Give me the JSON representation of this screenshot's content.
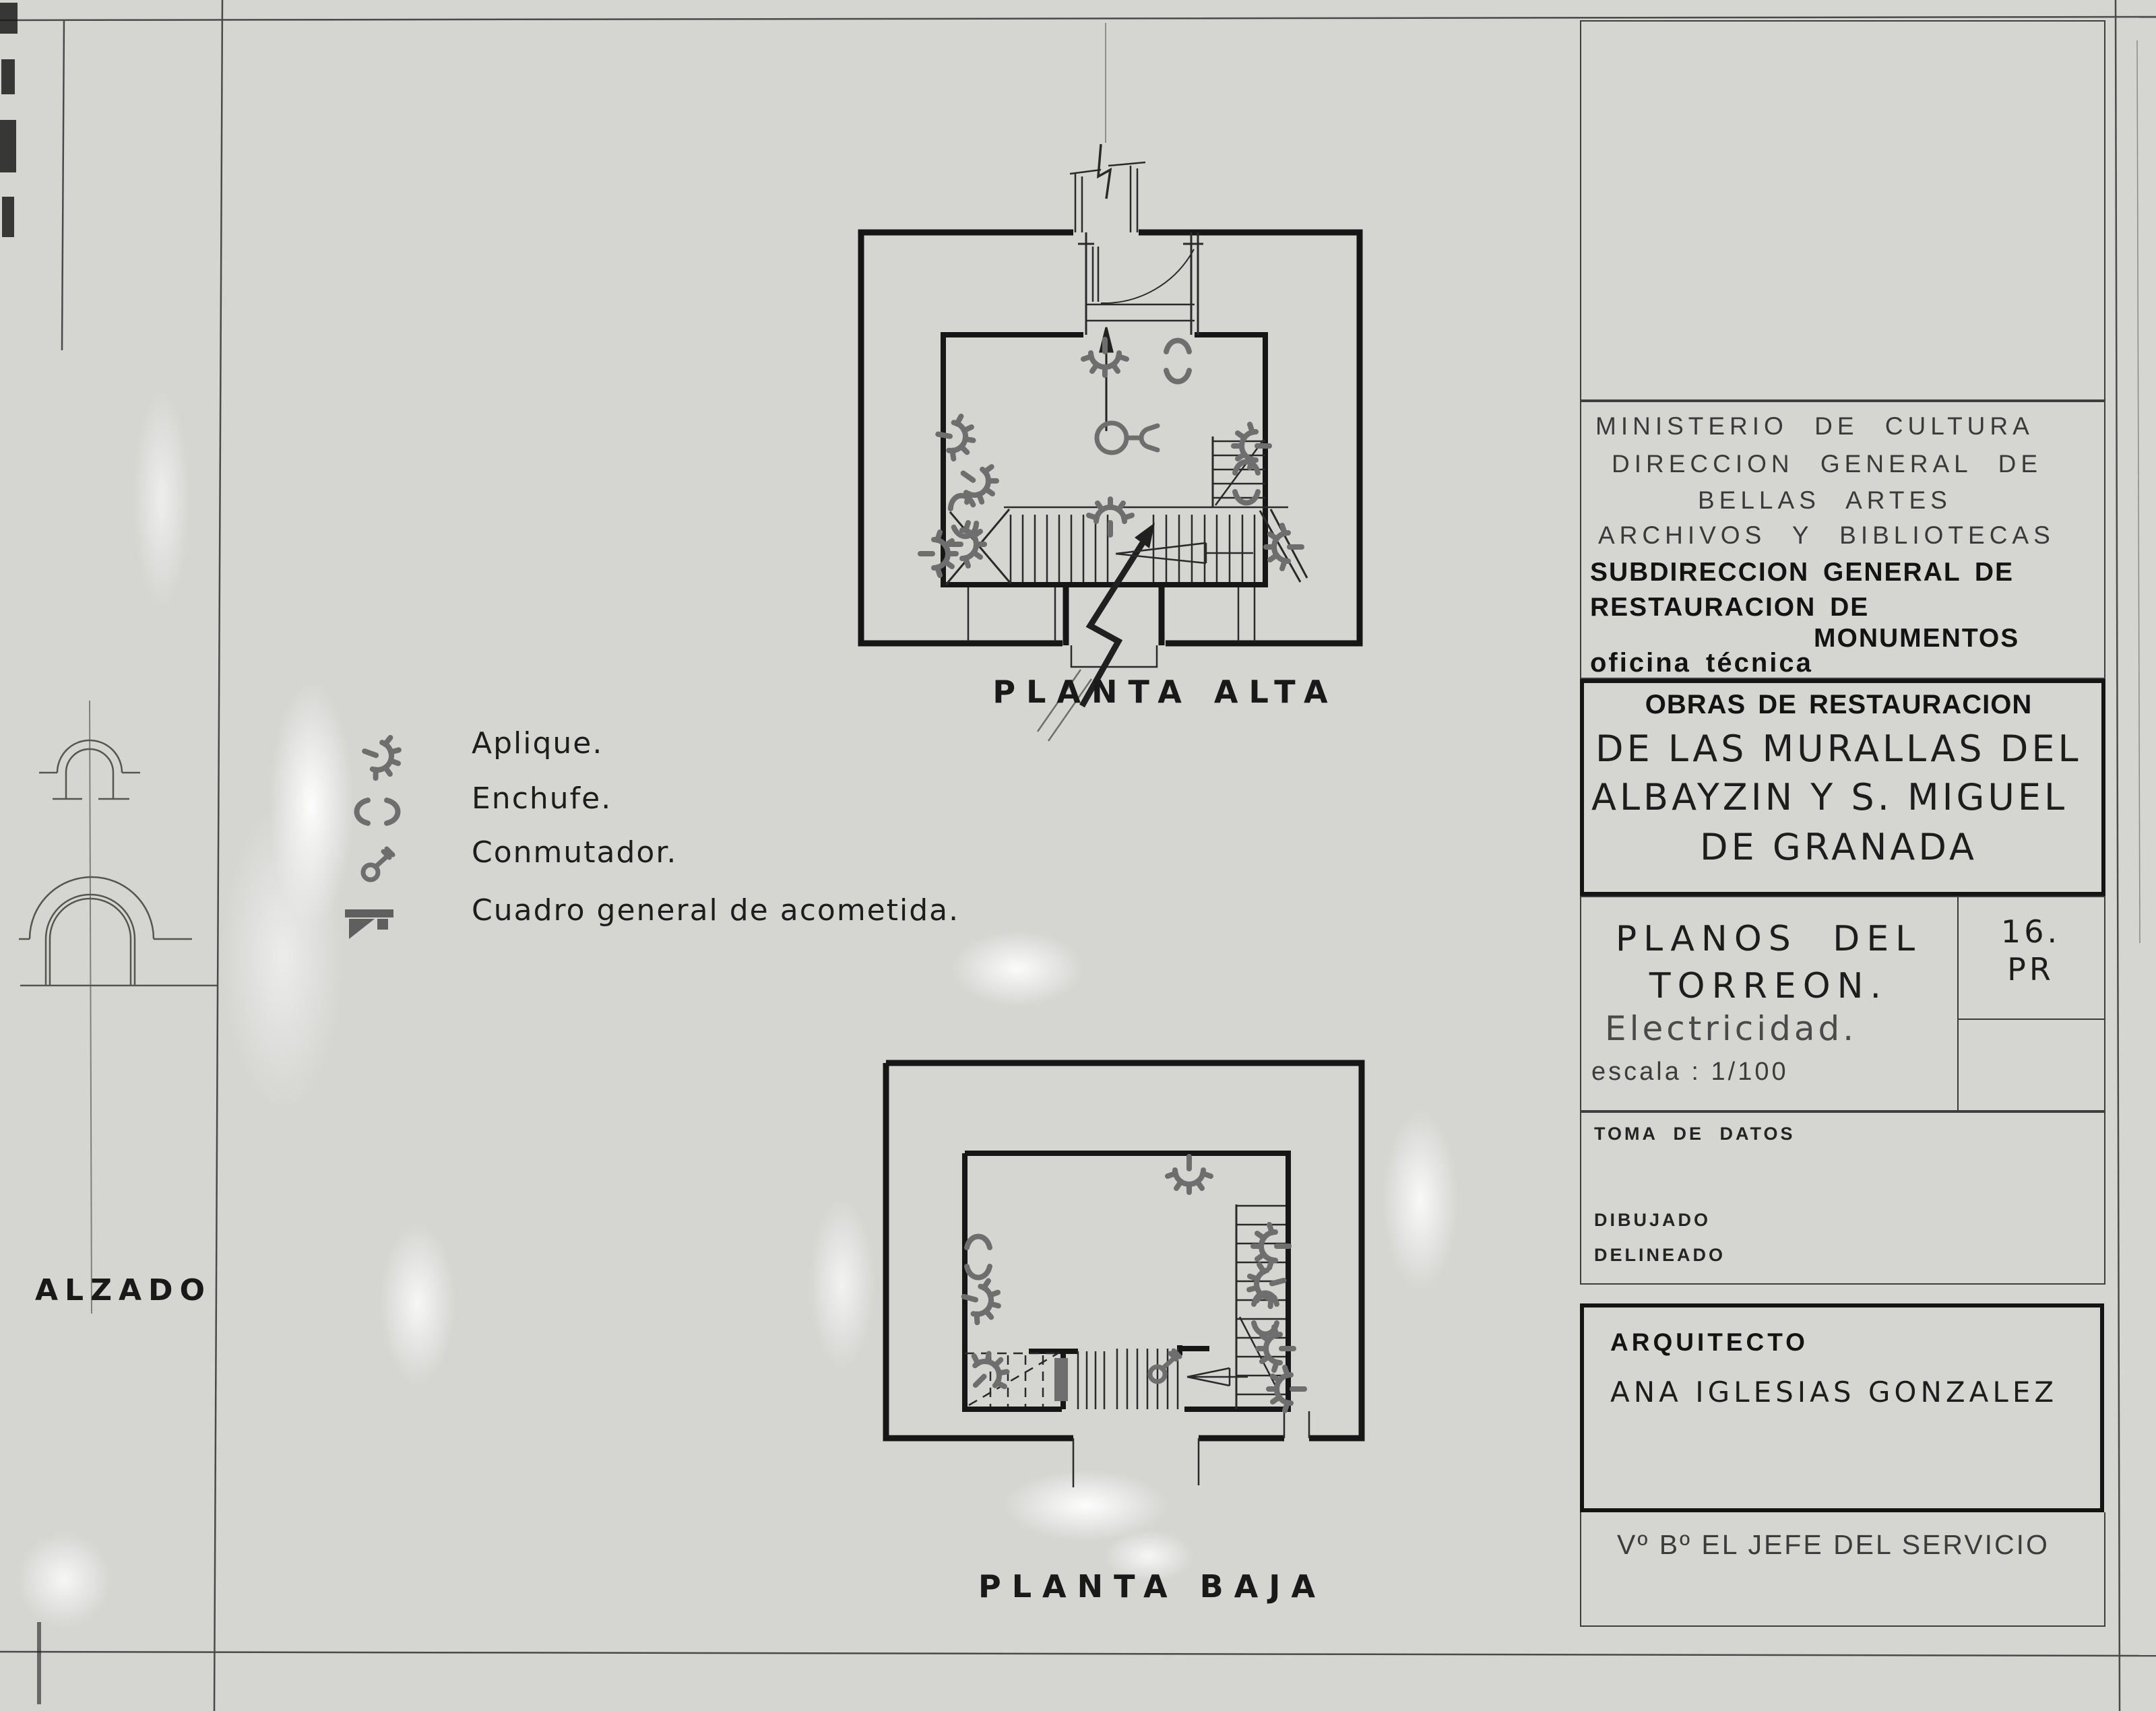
{
  "colors": {
    "paper": "#d5d6d2",
    "ink": "#1c1c1c",
    "symbol_gray": "#6e6e6e"
  },
  "plan_labels": {
    "upper": "PLANTA ALTA",
    "lower": "PLANTA BAJA",
    "elevation": "ALZADO"
  },
  "legend": {
    "items": [
      {
        "icon": "aplique-icon",
        "label": "Aplique."
      },
      {
        "icon": "enchufe-icon",
        "label": "Enchufe."
      },
      {
        "icon": "conmutador-icon",
        "label": "Conmutador."
      },
      {
        "icon": "cuadro-general-icon",
        "label": "Cuadro general de acometida."
      }
    ]
  },
  "title_block": {
    "ministry_lines": [
      "MINISTERIO DE CULTURA",
      "DIRECCION GENERAL DE",
      "BELLAS ARTES",
      "ARCHIVOS Y BIBLIOTECAS"
    ],
    "subdirection_lines": [
      "SUBDIRECCION GENERAL DE",
      "RESTAURACION DE",
      "MONUMENTOS"
    ],
    "office": "oficina técnica",
    "project_title": "OBRAS DE RESTAURACION",
    "project_lines": [
      "DE LAS MURALLAS DEL",
      "ALBAYZIN Y S. MIGUEL",
      "DE GRANADA"
    ],
    "drawing_title_lines": [
      "PLANOS DEL",
      "TORREON."
    ],
    "drawing_subject": "Electricidad.",
    "scale": "escala : 1/100",
    "sheet_number_line1": "16.",
    "sheet_number_line2": "PR",
    "field_toma": "TOMA DE DATOS",
    "field_dibujado": "DIBUJADO",
    "field_delineado": "DELINEADO",
    "architect_label": "ARQUITECTO",
    "architect_name": "ANA IGLESIAS GONZALEZ",
    "approval": "Vº Bº EL JEFE DEL SERVICIO"
  }
}
